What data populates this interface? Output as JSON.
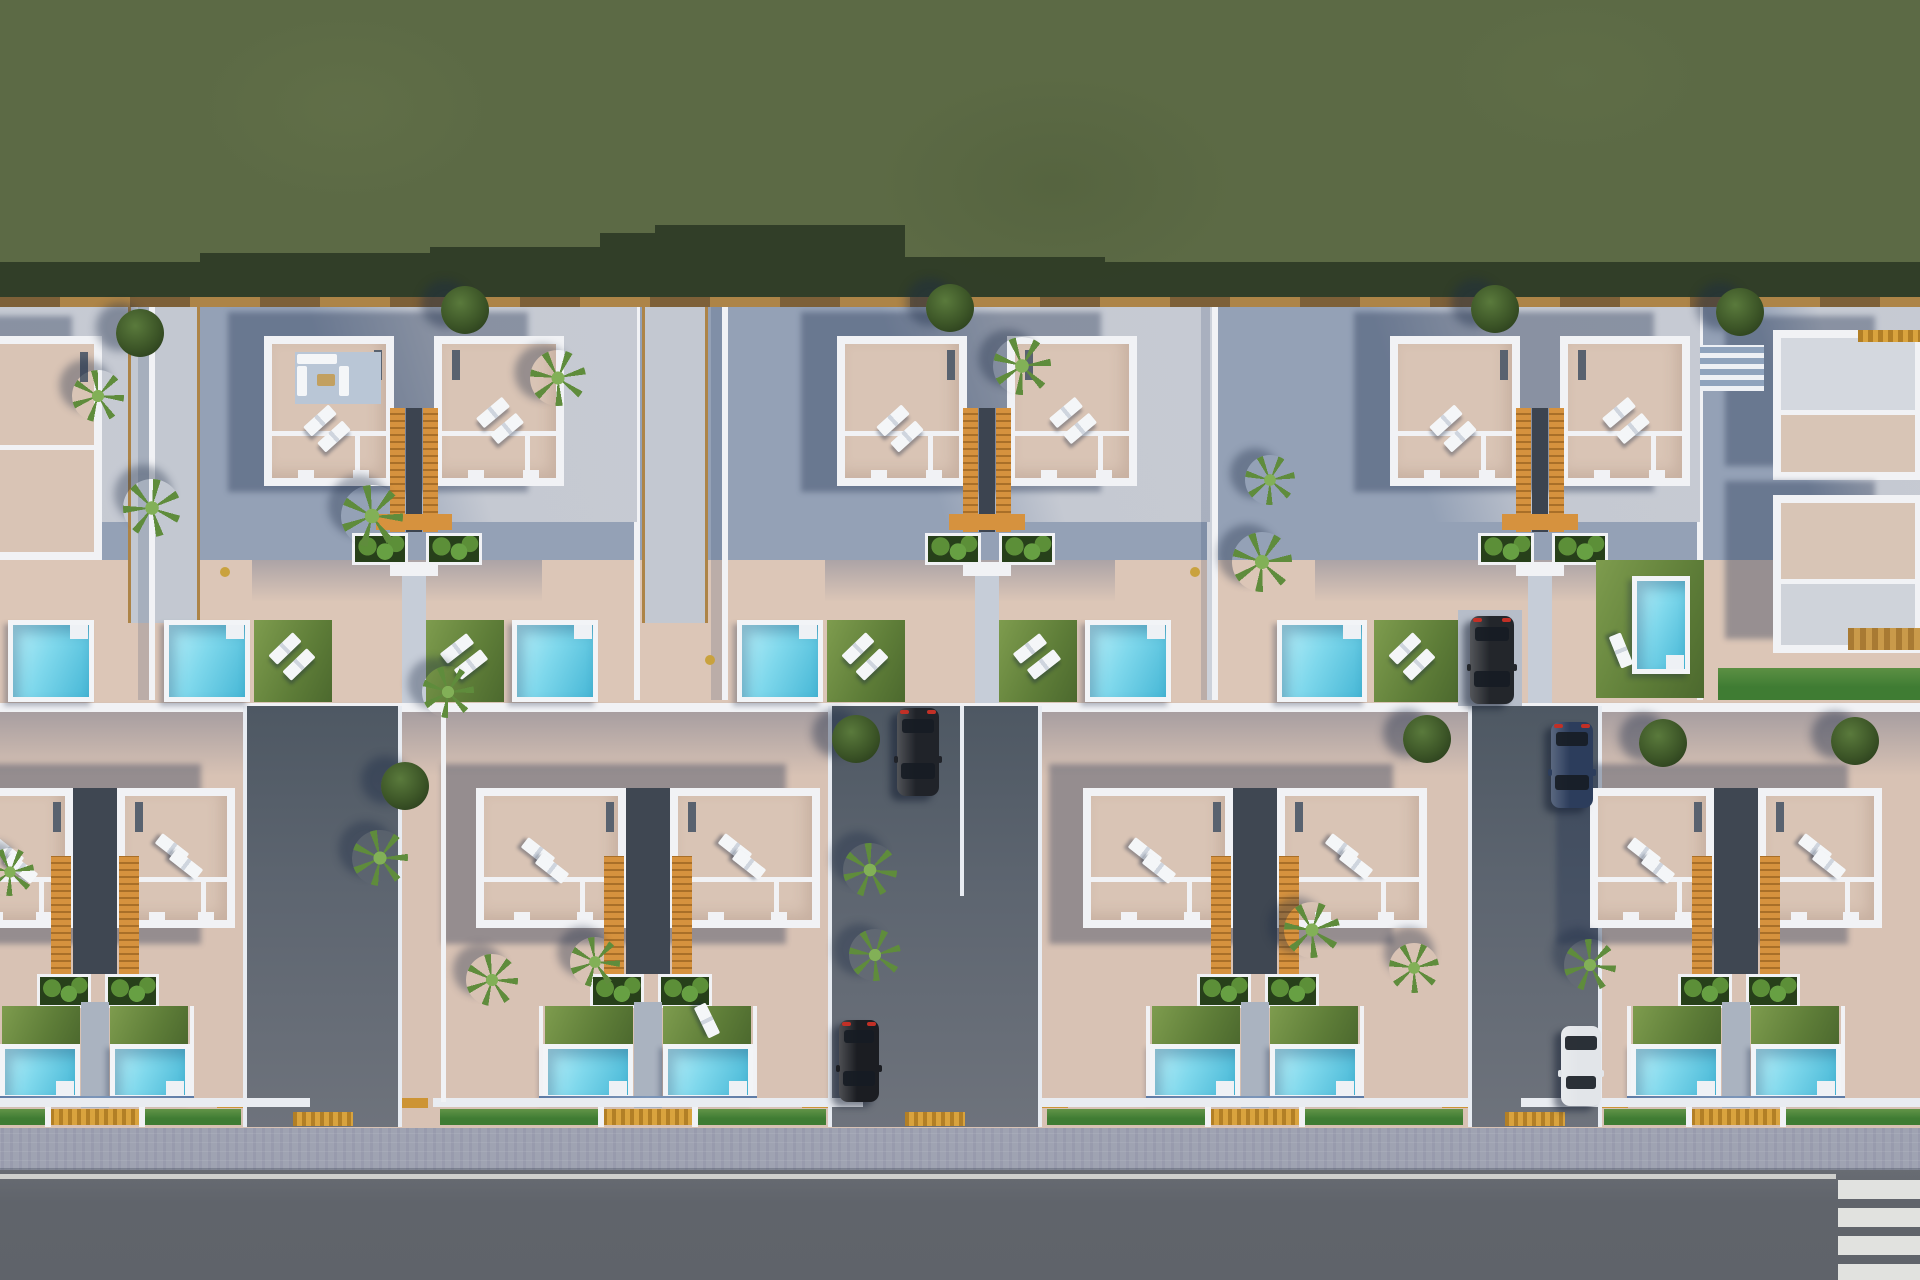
{
  "meta": {
    "title": "aerial-villa-development-render",
    "description": "Top-down 3D render of a residential villa development: grass field, two rows of white duplex villas with beige roof terraces, sun loungers, orange stairwells, cyan pools, lawns, driveways with parked cars, sidewalk and road with crosswalk."
  },
  "palette": {
    "grass": "#5c6a45",
    "grassShadow": "#2c3a25",
    "wallTan": "#7d6038",
    "wallTanLight": "#ad8447",
    "upperBase": "#94a1b6",
    "upperLit": "#c6cad3",
    "terrace": "#dcc6b7",
    "lowerBase": "#d8c2b4",
    "white": "#f1f2f5",
    "roof": "#d9c4b5",
    "orange": "#d6923e",
    "orangeDark": "#a96f28",
    "poolLight": "#b9eef8",
    "poolMid": "#7fd8ec",
    "poolDark": "#46b7d6",
    "lawnLight": "#7e9c4e",
    "lawnDark": "#4c692e",
    "planter": "#27401a",
    "bushA": "#5c8f38",
    "bushB": "#67a043",
    "alleyTop": "#4e5863",
    "alleyBot": "#6e737c",
    "road": "#63676e",
    "roadLine": "#d8d9d5",
    "sidewalk": "#9fa3b2",
    "hedge": "#3f7c33",
    "gold": "#cd9434",
    "steel": "#5d7ba6",
    "shadow": "rgba(30,46,78,0.36)",
    "treeDark": "#3c5527",
    "treeLight": "#5a7a3c",
    "palmA": "#5f8c3c",
    "palmB": "#82b057",
    "glass": "#161c24",
    "tailRed": "#c23026"
  },
  "scene": {
    "width": 1920,
    "height": 1280,
    "bands": {
      "grass": {
        "y": 0,
        "h": 306
      },
      "grassShadow": {
        "y": 225,
        "h": 81,
        "clip": "polygon(0 37px,200px 37px,200px 28px,430px 28px,430px 22px,600px 22px,600px 8px,655px 8px,655px 0,905px 0,905px 32px,1105px 32px,1105px 37px,1920px 37px,1920px 81px,0 81px)"
      },
      "boundaryWall": {
        "y": 297,
        "h": 10
      },
      "upperGround": {
        "y": 307,
        "h": 396
      },
      "terraceBand": {
        "y": 560,
        "h": 143
      },
      "midWall": {
        "y": 703,
        "h": 9
      },
      "lowerGround": {
        "y": 712,
        "h": 418
      },
      "lowerTopShadowH": 64,
      "sidewalk": {
        "y": 1128,
        "h": 42
      },
      "curb": {
        "y": 1168,
        "h": 4
      },
      "road": {
        "y": 1170,
        "h": 110
      },
      "roadEdgeLine": {
        "y": 1174,
        "h": 5,
        "x": 0,
        "w": 1836
      }
    },
    "crosswalk": {
      "x": 1838,
      "w": 82,
      "y": 1180,
      "stripeH": 19,
      "gap": 9,
      "count": 4
    },
    "topDefaults": {
      "w": 485,
      "villaY": 336,
      "villaH": 150,
      "villaW": 130,
      "villaOff": 112,
      "corrW": 40,
      "corrY": 408,
      "corrH": 124,
      "footerY": 514,
      "planterY": 533,
      "planterH": 26,
      "porchY": 562,
      "poolY": 620,
      "poolH": 82,
      "poolW": 86,
      "poolOffL": 12,
      "poolOffR": 360,
      "lawnW": 78,
      "lawnOffL": 102,
      "lawnOffR": 274
    },
    "topUnits": [
      {
        "id": "top-pair-b",
        "x": 152,
        "furnished": true
      },
      {
        "id": "top-pair-c",
        "x": 725
      },
      {
        "id": "top-pair-d",
        "x": 1215,
        "villaShift": 63,
        "leftPool": {
          "x": 1277,
          "w": 90
        },
        "leftLawn": {
          "x": 1374,
          "w": 84
        },
        "skipRightFront": true
      }
    ],
    "bottomDefaults": {
      "villaY": 788,
      "villaH": 140,
      "villaW": 150,
      "corrHalf": 22,
      "stairY": 856,
      "stairH": 118,
      "planterY": 974,
      "planterH": 28,
      "lawnY": 1006,
      "lawnH": 38,
      "poolY": 1044,
      "poolH": 56,
      "poolW": 90,
      "poolGap": 15,
      "steelY": 1096,
      "wallY": 1098,
      "hedgeY": 1109,
      "hedgeH": 16
    },
    "bottomUnits": [
      {
        "id": "bottom-pair-1",
        "cx": 95,
        "villaW": 118,
        "poolW": 80
      },
      {
        "id": "bottom-pair-2",
        "cx": 648,
        "fallenLounger": true
      },
      {
        "id": "bottom-pair-3",
        "cx": 1255
      },
      {
        "id": "bottom-pair-4",
        "cx": 1736,
        "villaW": 124
      }
    ],
    "alleys": [
      {
        "id": "alley-1",
        "x": 245,
        "w": 155
      },
      {
        "id": "alley-2",
        "x": 830,
        "w": 210,
        "divider": true
      },
      {
        "id": "alley-3",
        "x": 1470,
        "w": 130
      }
    ],
    "alleyY": {
      "y": 706,
      "h": 421
    },
    "treesRound": [
      [
        140,
        333
      ],
      [
        465,
        310
      ],
      [
        950,
        308
      ],
      [
        1495,
        309
      ],
      [
        1740,
        312
      ],
      [
        405,
        786
      ],
      [
        856,
        739
      ],
      [
        1427,
        739
      ],
      [
        1663,
        743
      ],
      [
        1855,
        741
      ]
    ],
    "palms": [
      [
        98,
        396,
        52
      ],
      [
        152,
        508,
        58
      ],
      [
        372,
        516,
        62
      ],
      [
        558,
        378,
        56
      ],
      [
        1022,
        366,
        58
      ],
      [
        1270,
        480,
        50
      ],
      [
        1262,
        562,
        60
      ],
      [
        448,
        692,
        52
      ],
      [
        380,
        858,
        56
      ],
      [
        492,
        980,
        52
      ],
      [
        595,
        962,
        50
      ],
      [
        870,
        870,
        54
      ],
      [
        875,
        955,
        52
      ],
      [
        1312,
        930,
        56
      ],
      [
        1414,
        968,
        50
      ],
      [
        1590,
        965,
        52
      ],
      [
        10,
        872,
        48
      ]
    ],
    "cars": [
      {
        "id": "car-suv-black",
        "x": 1470,
        "y": 616,
        "w": 44,
        "h": 88,
        "body": "#23262b",
        "tailTop": true
      },
      {
        "id": "car-navy-sedan",
        "x": 1551,
        "y": 722,
        "w": 42,
        "h": 86,
        "body": "#2c3d5c",
        "tailTop": true
      },
      {
        "id": "car-black-sedan-1",
        "x": 897,
        "y": 708,
        "w": 42,
        "h": 88,
        "body": "#202329",
        "tailTop": true
      },
      {
        "id": "car-black-sedan-2",
        "x": 839,
        "y": 1020,
        "w": 40,
        "h": 82,
        "body": "#1b1d22",
        "tailTop": true
      },
      {
        "id": "car-white-sedan",
        "x": 1561,
        "y": 1026,
        "w": 40,
        "h": 80,
        "body": "#e2e5e9",
        "tailTop": false
      }
    ],
    "extras": [
      {
        "kind": "lit",
        "x": -333,
        "y": 307,
        "w": 485,
        "h": 215
      },
      {
        "kind": "lit",
        "x": 1700,
        "y": 307,
        "w": 230,
        "h": 215
      },
      {
        "kind": "path",
        "x": 128,
        "y": 307,
        "w": 72,
        "h": 316
      },
      {
        "kind": "path",
        "x": 642,
        "y": 307,
        "w": 66,
        "h": 316
      },
      {
        "kind": "villaA",
        "x": -62,
        "y": 336,
        "w": 164,
        "h": 224
      },
      {
        "kind": "poolH",
        "x": 8,
        "y": 620,
        "w": 86,
        "h": 82
      },
      {
        "kind": "building",
        "id": "compound-upper-building",
        "x": 1773,
        "y": 330,
        "w": 150,
        "h": 150,
        "roofTop": "#d4d8df",
        "roofBottom": "#d8c5b6"
      },
      {
        "kind": "building",
        "id": "compound-lower-building",
        "x": 1773,
        "y": 495,
        "w": 150,
        "h": 158,
        "roofTop": "#d8c5b6",
        "roofBottom": "#cfd3da"
      },
      {
        "kind": "pergola",
        "x": 1700,
        "y": 345,
        "w": 64,
        "h": 46
      },
      {
        "kind": "goldstrip",
        "x": 1858,
        "y": 330,
        "w": 62,
        "h": 12
      },
      {
        "kind": "wooddeck",
        "x": 1848,
        "y": 628,
        "w": 72,
        "h": 22
      },
      {
        "kind": "lawn",
        "x": 1596,
        "y": 560,
        "w": 108,
        "h": 138
      },
      {
        "kind": "poolV",
        "x": 1632,
        "y": 576,
        "w": 58,
        "h": 98
      },
      {
        "kind": "hedgeStrip",
        "x": 1718,
        "y": 668,
        "w": 202,
        "h": 32
      },
      {
        "kind": "loungerSingle",
        "x": 1604,
        "y": 644,
        "rot": 68
      },
      {
        "kind": "pad",
        "x": 1458,
        "y": 610,
        "w": 64,
        "h": 96
      },
      {
        "kind": "vwall",
        "x": 441,
        "y": 712,
        "w": 5,
        "h": 390
      },
      {
        "kind": "dot",
        "x": 225,
        "y": 572,
        "r": 5
      },
      {
        "kind": "dot",
        "x": 710,
        "y": 660,
        "r": 5
      },
      {
        "kind": "dot",
        "x": 1195,
        "y": 572,
        "r": 5
      }
    ]
  }
}
